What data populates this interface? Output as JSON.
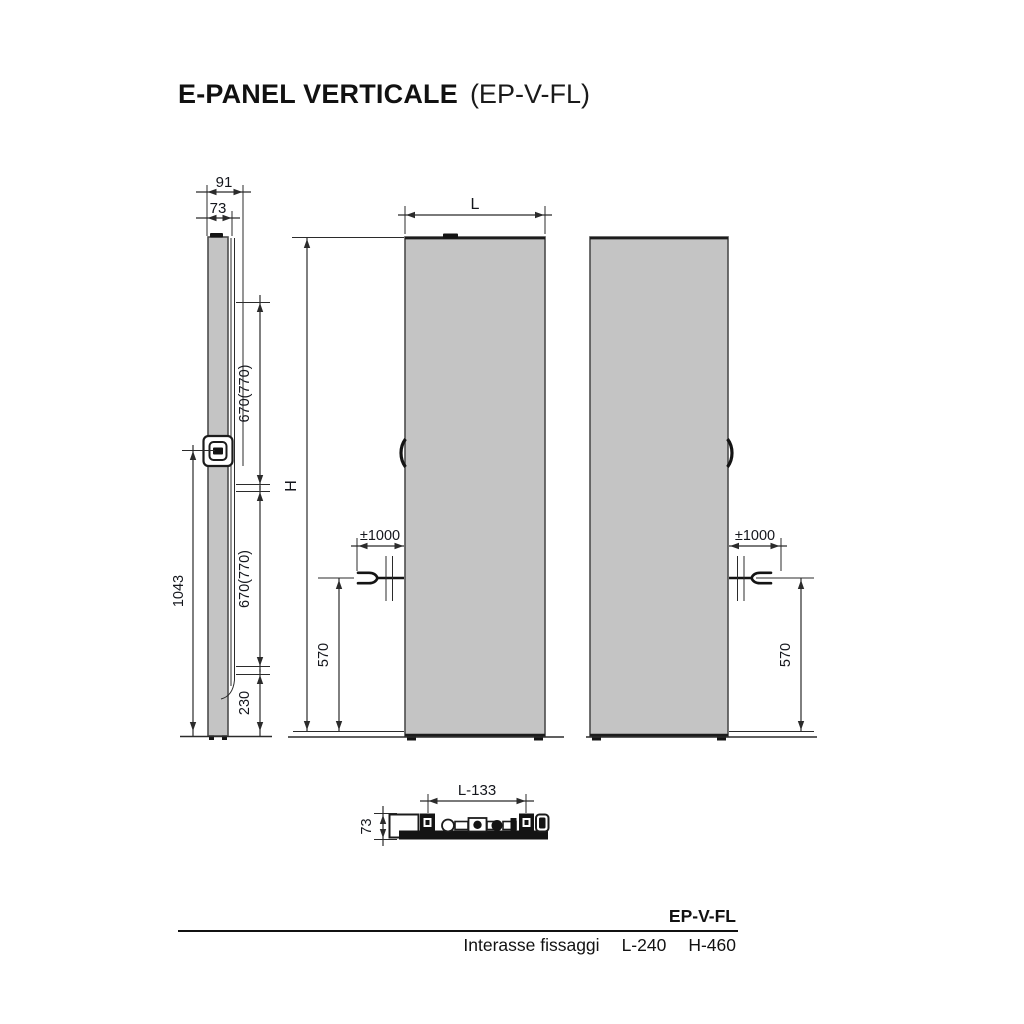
{
  "title": {
    "main": "E-PANEL VERTICALE",
    "code": "(EP-V-FL)"
  },
  "side_view": {
    "depth_total": "91",
    "depth_panel": "73",
    "fixing_top": "670(770)",
    "fixing_bottom": "670(770)",
    "bracket_height": "1043",
    "bottom_clearance": "230"
  },
  "front_view": {
    "width": "L",
    "height": "H",
    "cable_length": "±1000",
    "cable_height": "570"
  },
  "rear_view": {
    "cable_length": "±1000",
    "cable_height": "570"
  },
  "bottom_view": {
    "fixing_width": "L-133",
    "depth": "73"
  },
  "table": {
    "model": "EP-V-FL",
    "row_label": "Interasse fissaggi",
    "value_l": "L-240",
    "value_h": "H-460"
  },
  "colors": {
    "panel_fill": "#c4c4c4",
    "line": "#2b2b2b",
    "detail": "#141414"
  }
}
